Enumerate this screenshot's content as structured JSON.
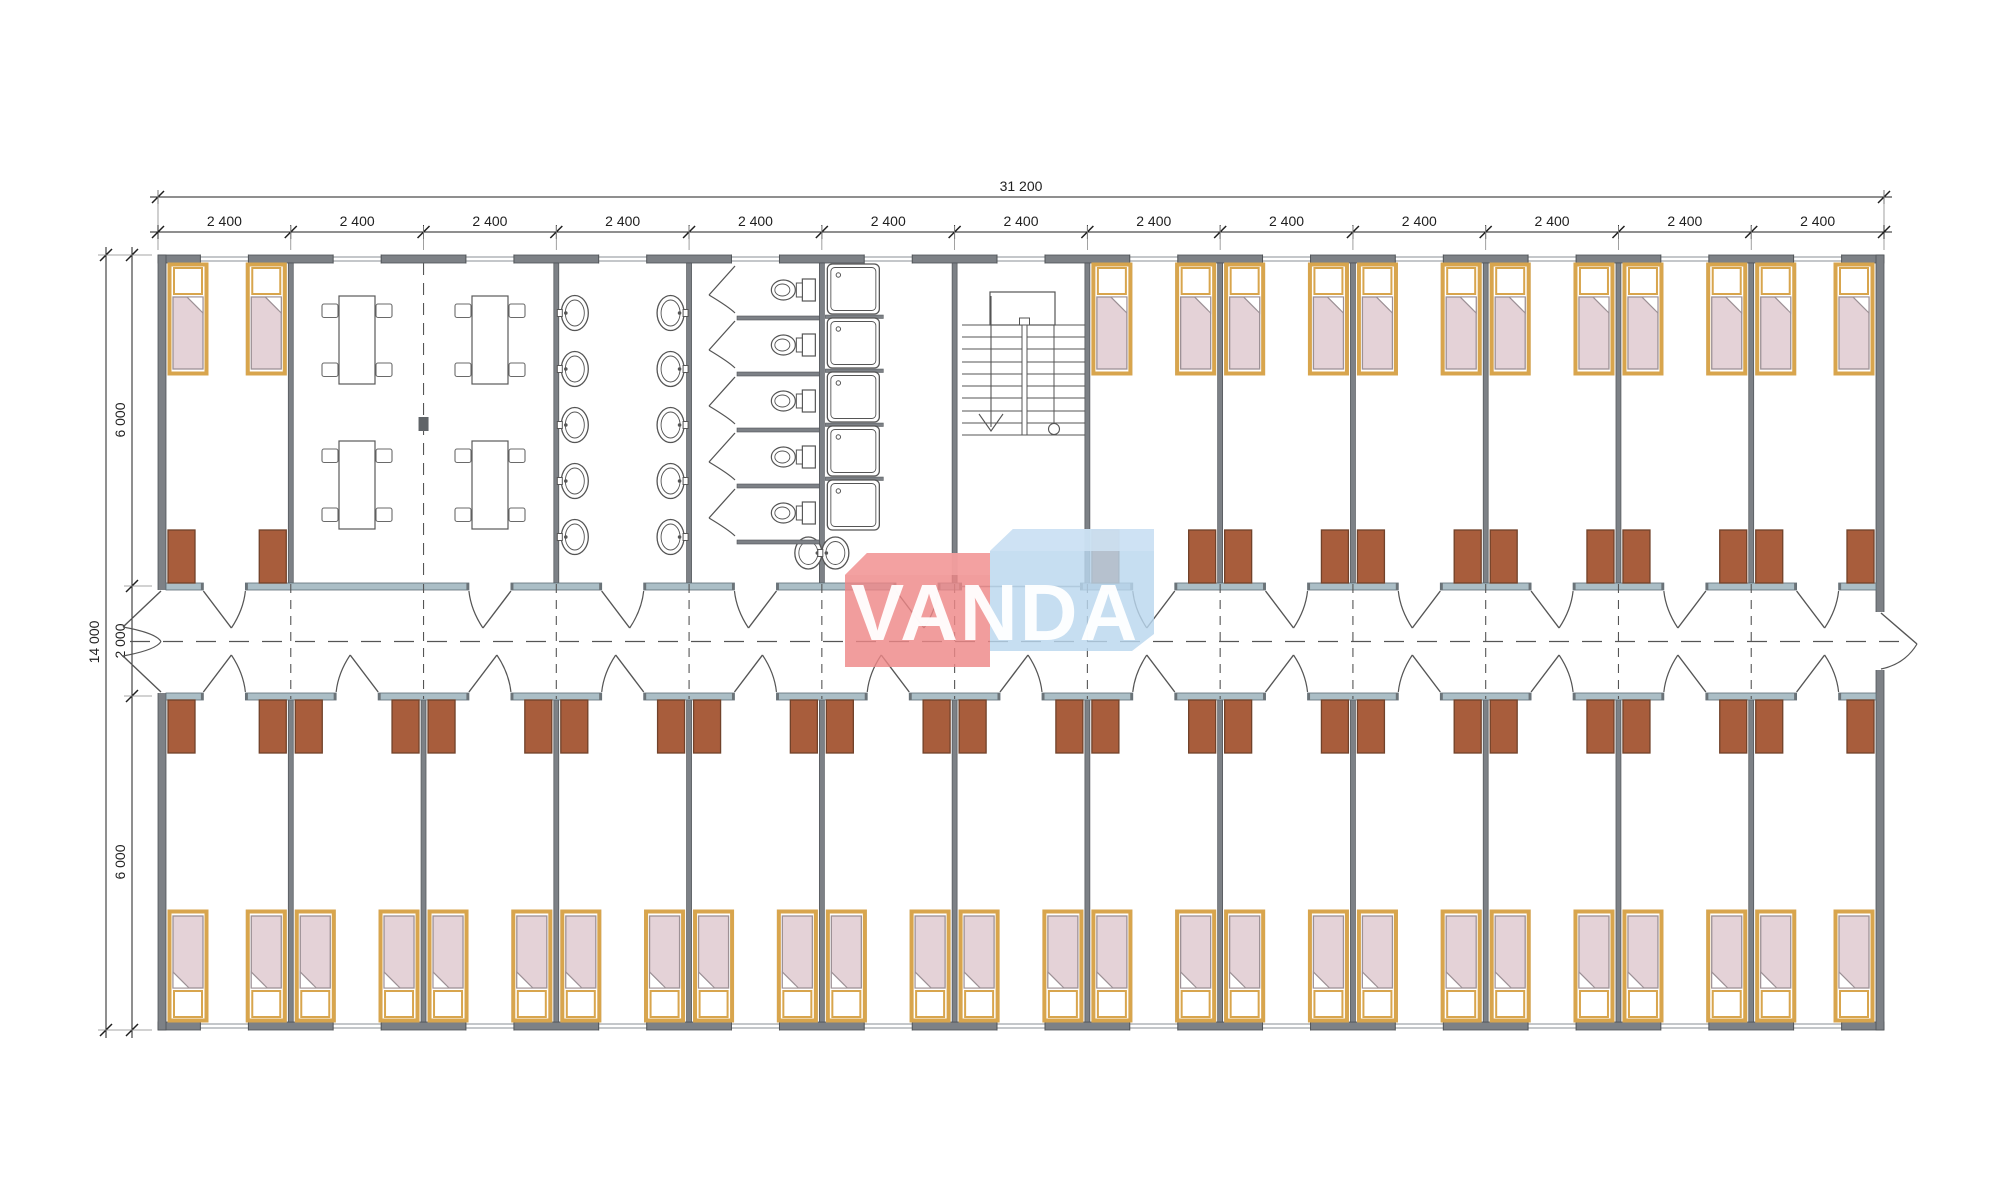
{
  "drawing": {
    "type": "container-dormitory-floor-plan",
    "bands": [
      "bedroom-band-top",
      "central-corridor",
      "bedroom-band-bottom"
    ]
  },
  "dims": {
    "top_total": "31 200",
    "top_modules": [
      "2 400",
      "2 400",
      "2 400",
      "2 400",
      "2 400",
      "2 400",
      "2 400",
      "2 400",
      "2 400",
      "2 400",
      "2 400",
      "2 400",
      "2 400"
    ],
    "left_total": "14 000",
    "left_segments": [
      "6 000",
      "2 000",
      "6 000"
    ]
  },
  "watermark": {
    "text": "VANDA",
    "red": "#ee8787",
    "red_light": "#f3a2a2",
    "blue": "#b9d7ee",
    "blue_light": "#cfe3f4"
  },
  "layout": {
    "module_count": 13,
    "module_mm": 2400,
    "total_width_mm": 31200,
    "total_height_mm": 14000,
    "band_mm": 6000,
    "corridor_mm": 2000,
    "rooms_top": [
      {
        "start": 0,
        "span": 1,
        "type": "bedroom"
      },
      {
        "start": 1,
        "span": 2,
        "type": "common-room"
      },
      {
        "start": 3,
        "span": 1,
        "type": "washroom"
      },
      {
        "start": 4,
        "span": 1,
        "type": "wc"
      },
      {
        "start": 5,
        "span": 1,
        "type": "shower-room"
      },
      {
        "start": 6,
        "span": 1,
        "type": "stairwell"
      },
      {
        "start": 7,
        "span": 6,
        "type": "bedrooms"
      }
    ],
    "rooms_bottom": [
      {
        "start": 0,
        "span": 13,
        "type": "bedrooms"
      }
    ],
    "counts": {
      "tables": 4,
      "chairs_per_table": 4,
      "washroom_sinks": 10,
      "wc_stalls": 5,
      "showers": 5,
      "extra_sinks": 2,
      "beds_top_band": 14,
      "beds_bottom_band": 26,
      "wardrobes_per_room": 2
    }
  },
  "colors": {
    "wall": "#7d8186",
    "wall_edge": "#4f5357",
    "corridor_wall": "#abbec6",
    "corridor_wall_edge": "#5f6d75",
    "bed_frame": "#d8a54d",
    "mattress": "#e4d2d7",
    "mattress_edge": "#9d9196",
    "pillow": "#ffffff",
    "wardrobe": "#a85d3c",
    "wardrobe_edge": "#71422a",
    "line": "#555555",
    "window_line": "#8a8f94",
    "dim": "#1f1f1f",
    "post": "#606468"
  }
}
